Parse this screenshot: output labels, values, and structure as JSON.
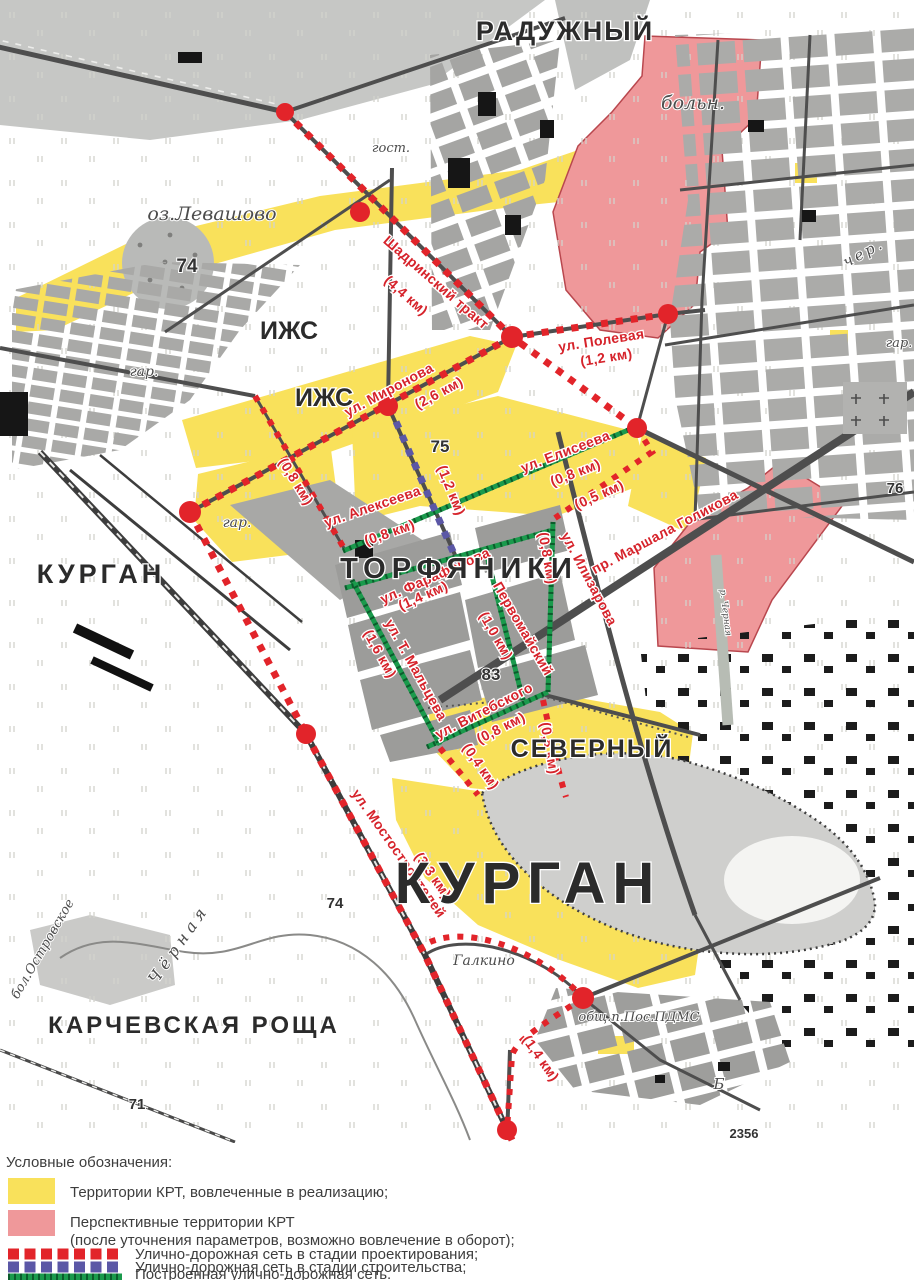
{
  "colors": {
    "krt_yellow": "#f9e15b",
    "krt_pink": "#ef989a",
    "pink_border": "#b9474e",
    "uds_design_red": "#e2242a",
    "uds_construction_blue": "#5b57a6",
    "uds_built_green": "#1a9a4c"
  },
  "map": {
    "streets": {
      "shadrinsky": {
        "name": "Шадринский тракт",
        "dist": "(4,4 км)"
      },
      "polevaya": {
        "name": "ул. Полевая",
        "dist": "(1,2 км)"
      },
      "mironova": {
        "name": "ул. Миронова",
        "dist": "(2,6 км)"
      },
      "left_segment": {
        "dist": "(0,8 км)"
      },
      "alekseeva": {
        "name": "ул. Алексеева",
        "dist": "(0,8 км)"
      },
      "construction_segment": {
        "dist": "(1,2 км)"
      },
      "eliseeva": {
        "name": "ул. Елисеева",
        "dist": "(0,8 км)"
      },
      "segment_05": {
        "dist": "(0,5 км)"
      },
      "ilizarova_segment": {
        "dist": "(0,8 км)"
      },
      "ilizarova": {
        "name": "ул. Илизарова"
      },
      "golikova": {
        "name": "пр. Маршала Голикова"
      },
      "farafonova": {
        "name": "ул. Фарафонова",
        "dist": "(1,4 км)"
      },
      "maltseva": {
        "name": "ул. Т. Мальцева",
        "dist": "(1,6 км)"
      },
      "pervomaisky": {
        "name": "Первомайский",
        "dist": "(1,0 км)"
      },
      "vitebskogo": {
        "name": "ул. Витебского",
        "dist": "(0,8 км)"
      },
      "segment_04": {
        "dist": "(0,4 км)"
      },
      "severny_segment": {
        "dist": "(0,8 км)"
      },
      "mostostroiteley": {
        "name": "ул. Мостостроителей",
        "dist": "(3,3 км)"
      },
      "segment_14": {
        "dist": "(1,4 км)"
      }
    },
    "places": {
      "raduzhny": "РАДУЖНЫЙ",
      "hospital": "больн.",
      "hotel": "гост.",
      "lake_levashovo": "оз.Левашово",
      "izhs_1": "ИЖС",
      "izhs_2": "ИЖС",
      "garage_1": "гар.",
      "garage_2": "гар.",
      "garage_3": "гар.",
      "kurgan_city": "КУРГАН",
      "torfyaniki": "ТОРФЯНИКИ",
      "severny": "СЕВЕРНЫЙ",
      "kurgan_mound": "КУРГАН",
      "galkino": "Галкино",
      "karchevskaya_roshcha": "КАРЧЕВСКАЯ РОЩА",
      "chernaya_river": "Чёрная",
      "chernaya_river_small": "р. Черная",
      "ostrovskoe_bog": "бол.Островское",
      "pdms": "общ.п.Пос.ПДМС",
      "b_mark": "Б",
      "cherem": "чер."
    },
    "numbers": {
      "h74": "74",
      "h75": "75",
      "h83": "83",
      "h76": "76",
      "h74b": "74",
      "h71": "71",
      "mark2356": "2356"
    }
  },
  "legend": {
    "title": "Условные обозначения:",
    "krt_active": "Территории КРТ, вовлеченные в реализацию;",
    "krt_prospective_1": "Перспективные территории КРТ",
    "krt_prospective_2": "(после уточнения параметров, возможно вовлечение в оборот);",
    "uds_design": "Улично-дорожная сеть в стадии проектирования;",
    "uds_construction": "Улично-дорожная сеть в стадии строительства;",
    "uds_built": "Построенная улично-дорожная сеть."
  }
}
